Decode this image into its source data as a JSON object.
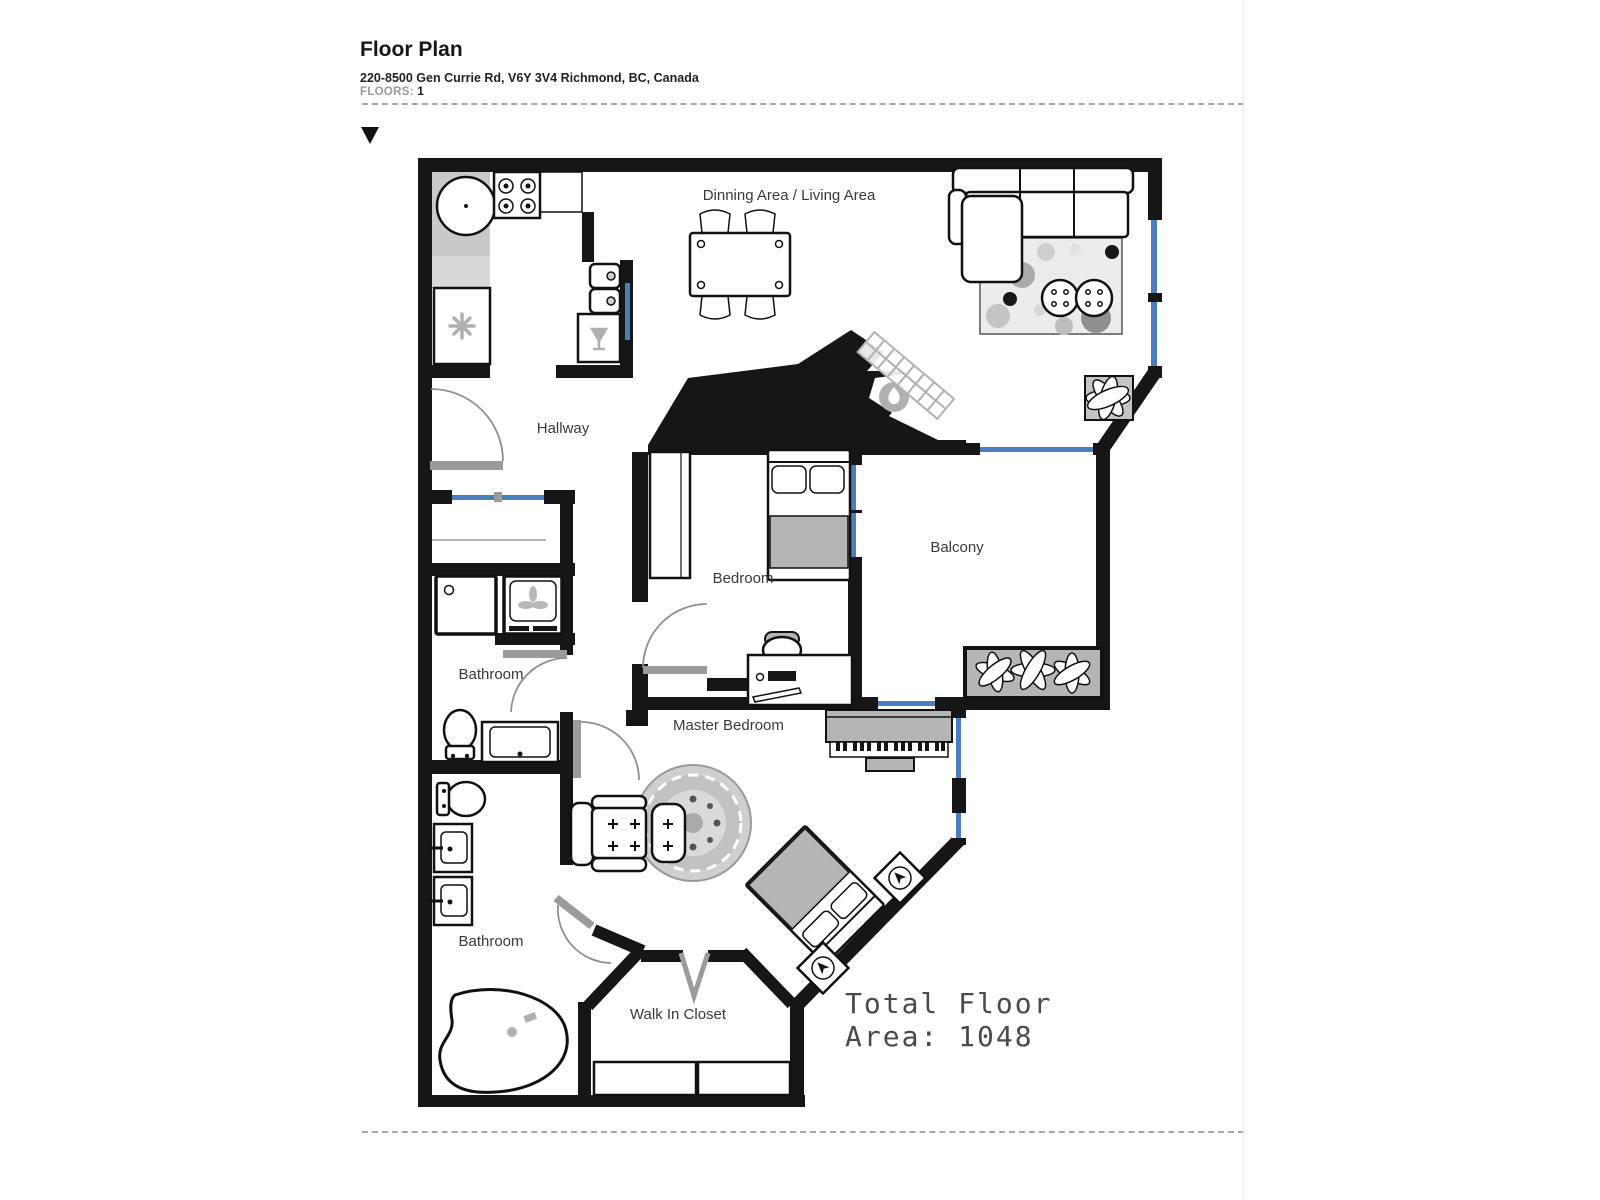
{
  "header": {
    "title": "Floor Plan",
    "address": "220-8500 Gen Currie Rd, V6Y 3V4 Richmond, BC, Canada",
    "floors_label": "FLOORS:",
    "floors_value": "1"
  },
  "plan": {
    "rooms": [
      {
        "id": "dining-living",
        "label": "Dinning Area / Living Area"
      },
      {
        "id": "hallway",
        "label": "Hallway"
      },
      {
        "id": "bedroom",
        "label": "Bedroom"
      },
      {
        "id": "balcony",
        "label": "Balcony"
      },
      {
        "id": "bathroom-upper",
        "label": "Bathroom"
      },
      {
        "id": "master-bedroom",
        "label": "Master Bedroom"
      },
      {
        "id": "bathroom-lower",
        "label": "Bathroom"
      },
      {
        "id": "walk-in-closet",
        "label": "Walk In Closet"
      }
    ],
    "total_area": {
      "line1": "Total Floor",
      "line2": "Area: 1048"
    },
    "icons": {
      "marker": "down-triangle",
      "fireplace": "flame-icon",
      "fridge": "snowflake-icon",
      "washer": "fan-icon",
      "wine_cabinet": "wine-glass-icon"
    }
  },
  "colors": {
    "wall": "#161616",
    "window": "#4a7ec0",
    "threshold": "#9b9b9b",
    "furniture_gray": "#b5b5b5",
    "label_text": "#3a3a3a"
  }
}
